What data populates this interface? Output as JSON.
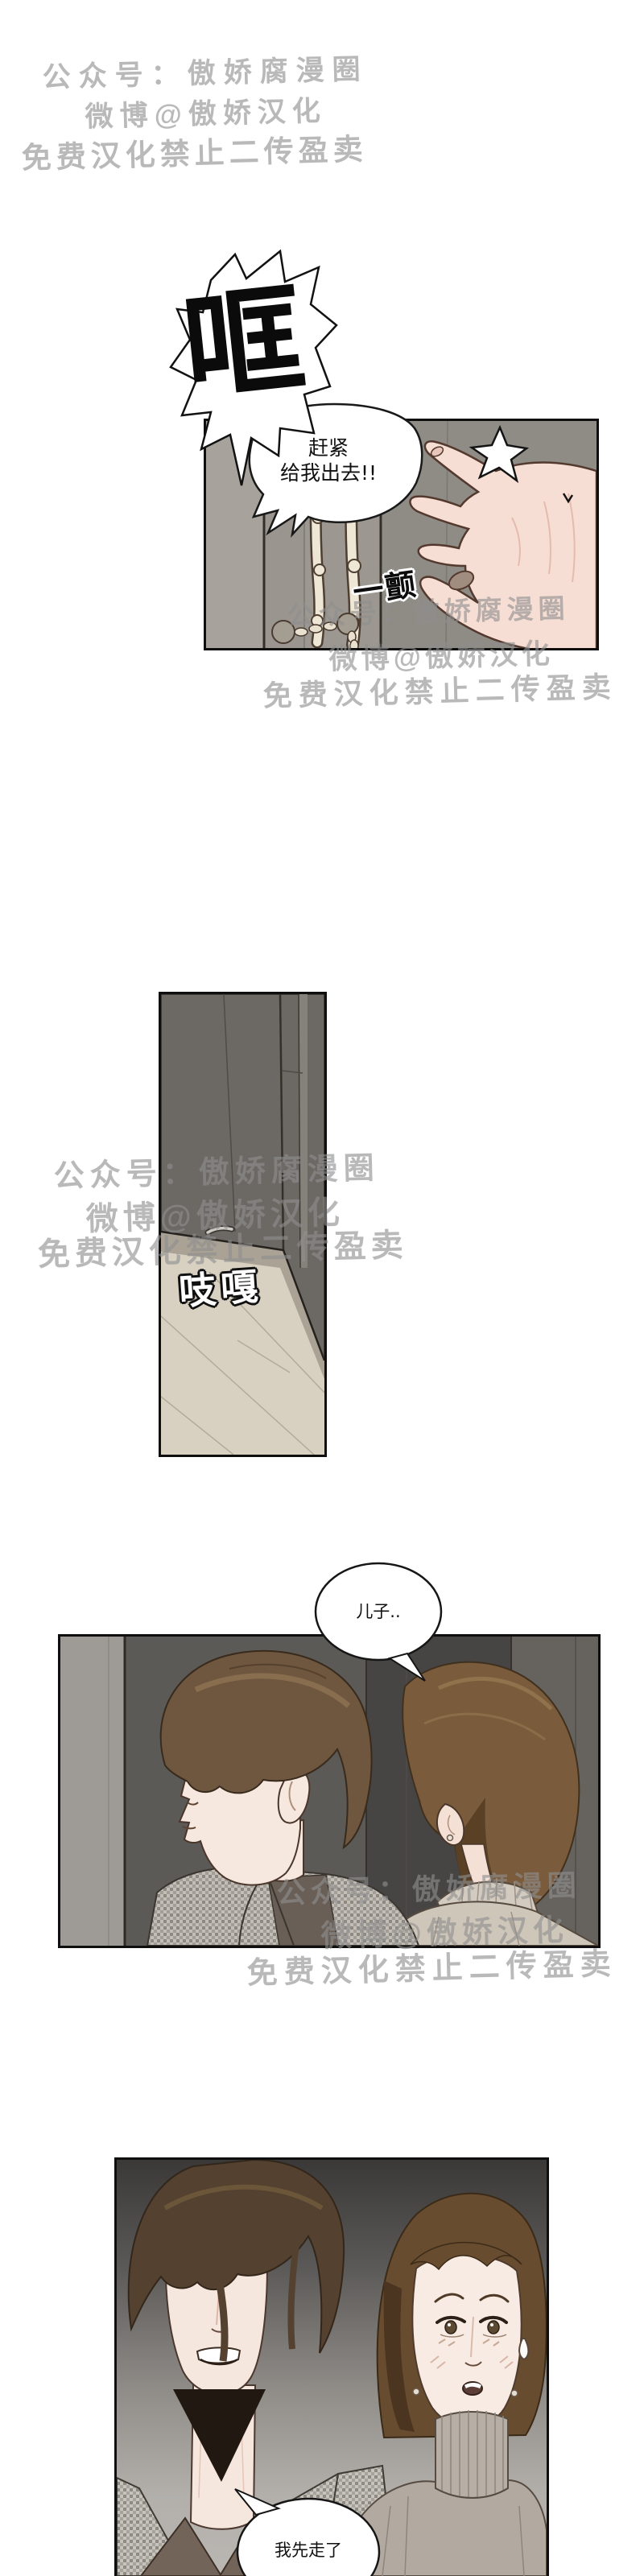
{
  "watermark": {
    "public_account": "公众号：傲娇腐漫圈",
    "weibo": "微博@傲娇汉化",
    "notice": "免费汉化禁止二传盈卖"
  },
  "sfx": {
    "door_slam": "哐",
    "tremble": "一颤",
    "door_creak": "吱嘎"
  },
  "speech": {
    "panel1_line1": "赶紧",
    "panel1_line2": "给我出去!!",
    "panel3": "儿子..",
    "panel4": "我先走了"
  },
  "colors": {
    "watermark_gray": "#8f8f8f",
    "panel_border": "#0f0f0f",
    "door_light": "#9a968f",
    "door_dark": "#6c6863",
    "floor": "#d8d1c2",
    "skin": "#f5e3d9",
    "hair_brown": "#6f5741",
    "hair_dark": "#54412f",
    "blazer_gray": "#c2beb7"
  }
}
